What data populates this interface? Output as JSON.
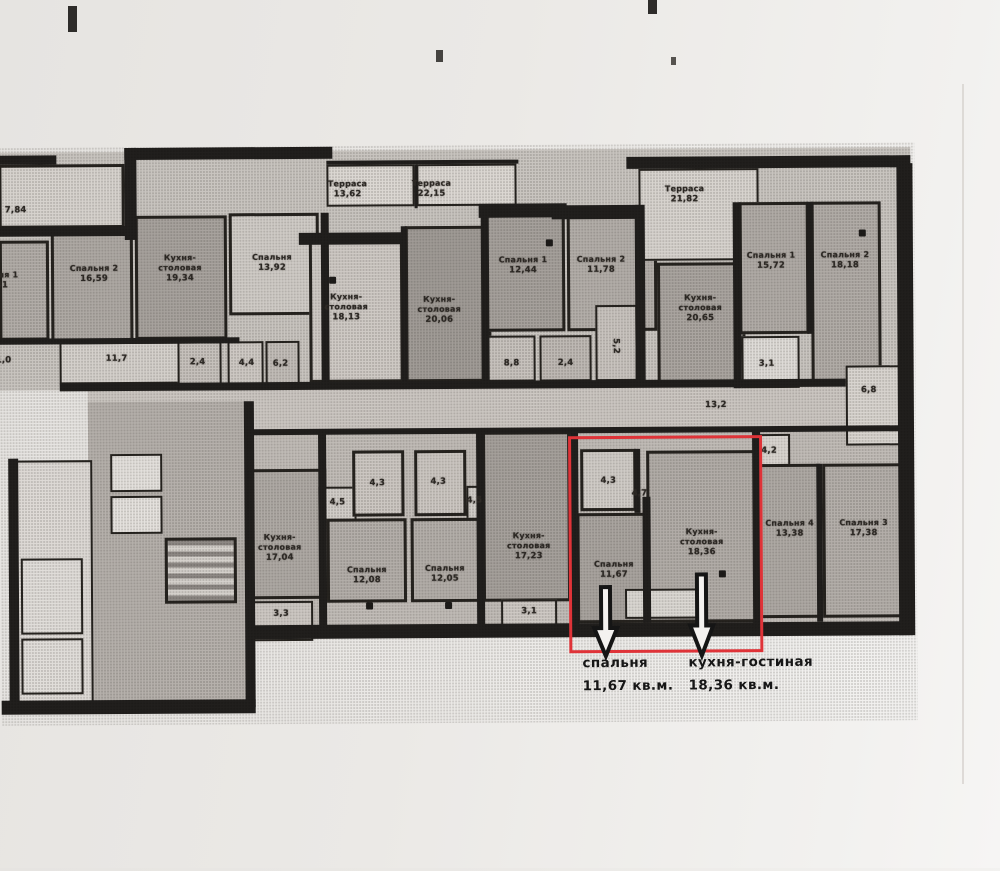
{
  "labels": {
    "p784": {
      "area": "7,84"
    },
    "sp1l": {
      "name": "Спальня 1",
      "area": "12,41"
    },
    "sp2l": {
      "name": "Спальня 2",
      "area": "16,59"
    },
    "kit1934": {
      "name": "Кухня-столовая",
      "area": "19,34"
    },
    "s1392": {
      "name": "Спальня",
      "area": "13,92"
    },
    "h117": {
      "area": "11,7"
    },
    "n24a": {
      "area": "2,4"
    },
    "n44": {
      "area": "4,4"
    },
    "n62": {
      "area": "6,2"
    },
    "n10": {
      "area": "1,0"
    },
    "terr1362": {
      "name": "Терраса",
      "area": "13,62"
    },
    "terr2215": {
      "name": "Терраса",
      "area": "22,15"
    },
    "kit1813": {
      "name": "Кухня-столовая",
      "area": "18,13"
    },
    "kit2006": {
      "name": "Кухня-столовая",
      "area": "20,06"
    },
    "sp1_1244": {
      "name": "Спальня 1",
      "area": "12,44"
    },
    "sp2_1178": {
      "name": "Спальня 2",
      "area": "11,78"
    },
    "n88": {
      "area": "8,8"
    },
    "n24b": {
      "area": "2,4"
    },
    "n52": {
      "area": "5,2"
    },
    "terr2182": {
      "name": "Терраса",
      "area": "21,82"
    },
    "kit2065": {
      "name": "Кухня-столовая",
      "area": "20,65"
    },
    "sp1_1572": {
      "name": "Спальня 1",
      "area": "15,72"
    },
    "sp2_1818": {
      "name": "Спальня 2",
      "area": "18,18"
    },
    "n31a": {
      "area": "3,1"
    },
    "n68": {
      "area": "6,8"
    },
    "n132": {
      "area": "13,2"
    },
    "kit1704": {
      "name": "Кухня-столовая",
      "area": "17,04"
    },
    "n33": {
      "area": "3,3"
    },
    "n45a": {
      "area": "4,5"
    },
    "n43a": {
      "area": "4,3"
    },
    "n43b": {
      "area": "4,3"
    },
    "n45b": {
      "area": "4,5"
    },
    "s1208": {
      "name": "Спальня",
      "area": "12,08"
    },
    "s1205": {
      "name": "Спальня",
      "area": "12,05"
    },
    "kit1723": {
      "name": "Кухня-столовая",
      "area": "17,23"
    },
    "n31b": {
      "area": "3,1"
    },
    "n43c": {
      "area": "4,3"
    },
    "n47": {
      "area": "4,7"
    },
    "s1167": {
      "name": "Спальня",
      "area": "11,67"
    },
    "kit1836": {
      "name": "Кухня-столовая",
      "area": "18,36"
    },
    "n42": {
      "area": "4,2"
    },
    "s1338": {
      "name": "Спальня 4",
      "area": "13,38"
    },
    "s1738": {
      "name": "Спальня 3",
      "area": "17,38"
    }
  },
  "annotations": {
    "bedroom": {
      "label": "спальня",
      "area": "11,67 кв.м."
    },
    "kitchen": {
      "label": "кухня-гостиная",
      "area": "18,36 кв.м."
    }
  },
  "colors": {
    "highlight_red": "#df3338",
    "wall_black": "#211f1d",
    "paper": "#ebe9e6"
  }
}
